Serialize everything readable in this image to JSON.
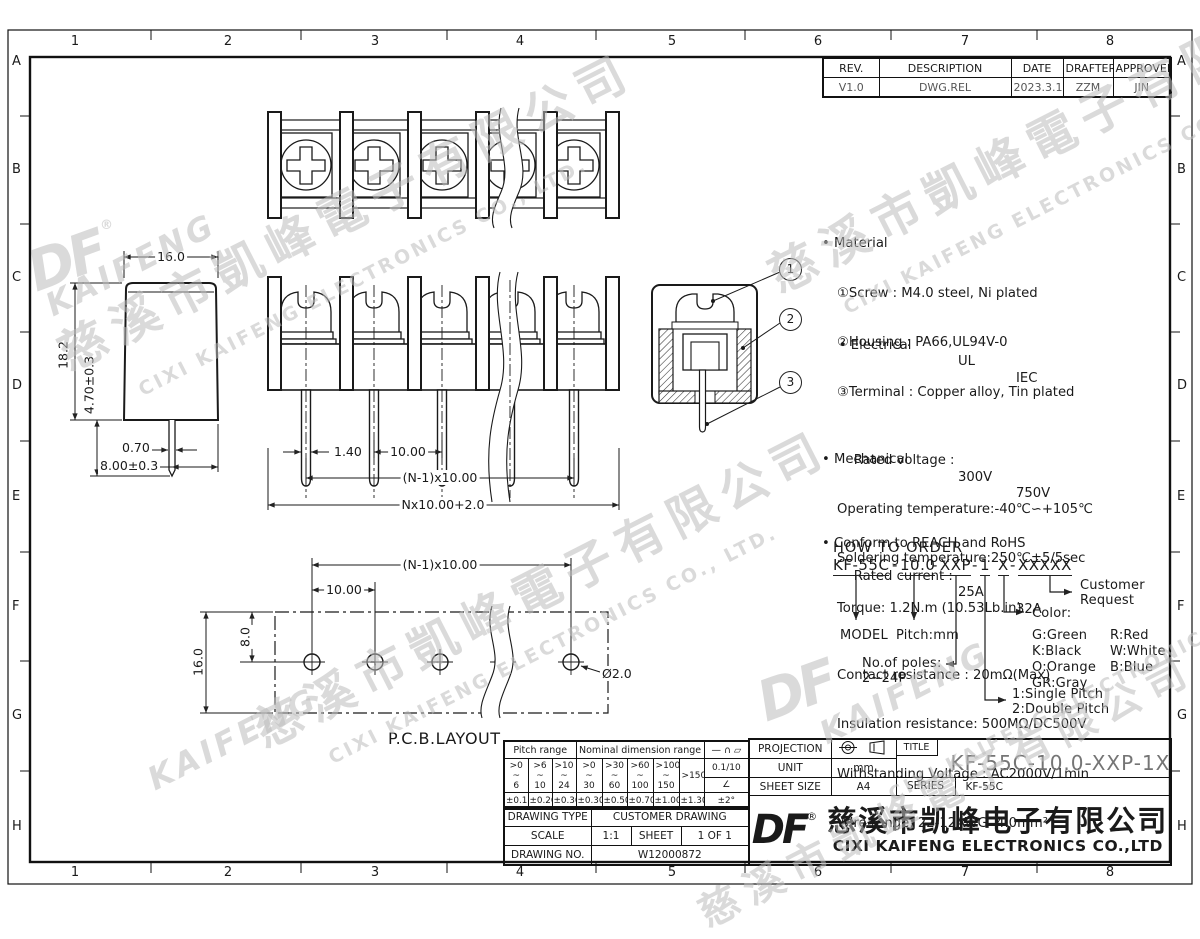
{
  "grid": {
    "cols": [
      "1",
      "2",
      "3",
      "4",
      "5",
      "6",
      "7",
      "8"
    ],
    "rows": [
      "A",
      "B",
      "C",
      "D",
      "E",
      "F",
      "G",
      "H"
    ]
  },
  "revision_table": {
    "headers": [
      "REV.",
      "DESCRIPTION",
      "DATE",
      "DRAFTER",
      "APPROVER"
    ],
    "row": {
      "rev": "V1.0",
      "description": "DWG.REL",
      "date": "2023.3.17",
      "drafter": "ZZM",
      "approver": "JIN"
    }
  },
  "dims": {
    "front": {
      "pin_width": "1.40",
      "pitch": "10.00",
      "span": "(N-1)x10.00",
      "total": "Nx10.00+2.0"
    },
    "side": {
      "width": "16.0",
      "height": "18.2",
      "pin_length": "4.70±0.3",
      "pin_width": "0.70",
      "pin_offset": "8.00±0.3"
    },
    "pcb": {
      "label": "P.C.B.LAYOUT",
      "span": "(N-1)x10.00",
      "pitch": "10.00",
      "row_offset": "8.0",
      "depth": "16.0",
      "hole_dia": "Ø2.0"
    }
  },
  "balloons": [
    "1",
    "2",
    "3"
  ],
  "specs": {
    "material": {
      "title": "Material",
      "items": [
        "①Screw : M4.0 steel, Ni plated",
        "②Housing : PA66,UL94V-0",
        "③Terminal : Copper alloy, Tin plated"
      ]
    },
    "electrical": {
      "title": "Electrical",
      "col1": "UL",
      "col2": "IEC",
      "rows": [
        {
          "label": "Rated voltage :",
          "ul": "300V",
          "iec": "750V"
        },
        {
          "label": "Rated current :",
          "ul": "25A",
          "iec": "32A"
        }
      ],
      "items": [
        "Contact resistance : 20mΩ(Max)",
        "Insulation resistance: 500MΩ/DC500V",
        "Withstanding Voltage : AC2000V/1min",
        "Wire range: 22-12AWG  4.0mm²"
      ]
    },
    "mechanical": {
      "title": "Mechanical",
      "items": [
        "Operating temperature:-40℃∽+105℃",
        "Soldering temperature:250℃±5/5sec",
        "Torque: 1.2N.m (10.53Lb.in)"
      ]
    },
    "compliance": "Conform to REACH and RoHS"
  },
  "how_to_order": {
    "title": "HOW TO ORDER",
    "segments": [
      "KF-55C",
      "10.0",
      "XXP",
      "1",
      "X",
      "XXXXX"
    ],
    "sep": "-",
    "model_label": "MODEL",
    "pitch_label": "Pitch:mm",
    "poles_label": "No.of poles:",
    "poles_range": "2~24P",
    "pitch_type_1": "1:Single Pitch",
    "pitch_type_2": "2:Double Pitch",
    "color_title": "Color:",
    "colors": [
      [
        "G:Green",
        "R:Red"
      ],
      [
        "K:Black",
        "W:White"
      ],
      [
        "O:Orange",
        "B:Blue"
      ],
      [
        "GR:Gray",
        ""
      ]
    ],
    "customer_1": "Customer",
    "customer_2": "Request"
  },
  "tolerance_table": {
    "pitch_header": "Pitch range",
    "nominal_header": "Nominal dimension range",
    "symbols_header": "— ∩ ▱",
    "pitch_cols": [
      ">0\n~\n6",
      ">6\n~\n10",
      ">10\n~\n24"
    ],
    "nominal_cols": [
      ">0\n~\n30",
      ">30\n~\n60",
      ">60\n~\n100",
      ">100\n~\n150"
    ],
    "nominal_last": ">150",
    "pitch_tols": [
      "±0.15",
      "±0.20",
      "±0.30"
    ],
    "nominal_tols": [
      "±0.30",
      "±0.50",
      "±0.70",
      "±1.00",
      "±1.30"
    ],
    "flatness": "0.1/10",
    "angle_symbol": "∠",
    "angle_tol": "±2°"
  },
  "info_table": {
    "drawing_type_label": "DRAWING TYPE",
    "drawing_type": "CUSTOMER DRAWING",
    "scale_label": "SCALE",
    "scale": "1:1",
    "sheet_label": "SHEET",
    "sheet": "1 OF 1",
    "drawing_no_label": "DRAWING NO.",
    "drawing_no": "W12000872"
  },
  "title_block": {
    "projection_label": "PROJECTION",
    "title_label": "TITLE",
    "title": "KF-55C-10.0-XXP-1X",
    "unit_label": "UNIT",
    "unit": "mm",
    "sheet_size_label": "SHEET SIZE",
    "sheet_size": "A4",
    "series_label": "SERIES",
    "series": "KF-55C",
    "logo": "DF",
    "reg": "®",
    "company_cn": "慈溪市凯峰电子有限公司",
    "company_en": "CIXI KAIFENG ELECTRONICS CO.,LTD"
  },
  "watermark": {
    "cn": "慈溪市凱峰電子有限公司",
    "en": "CIXI KAIFENG ELECTRONICS CO., LTD.",
    "brand": "KAIFENG",
    "logo": "DF",
    "reg": "®"
  }
}
